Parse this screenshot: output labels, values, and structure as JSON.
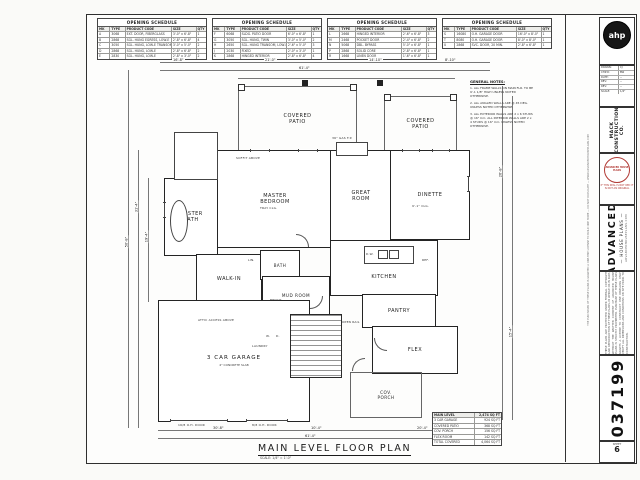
{
  "sheet": {
    "title": "MAIN LEVEL FLOOR PLAN",
    "scale": "SCALE: 1/4\" = 1'-0\""
  },
  "schedules": {
    "title": "OPENING SCHEDULE",
    "tables": [
      {
        "rows": [
          [
            "MK",
            "TYPE",
            "PRODUCT CODE",
            "SIZE",
            "QTY"
          ],
          [
            "A",
            "3068",
            "EXT. DOOR, FIBERGLASS",
            "3'-0\" x 6'-8\"",
            "1"
          ],
          [
            "B",
            "2868",
            "SGL. HUNG EGRESS, LOW-E",
            "2'-8\" x 6'-8\"",
            "4"
          ],
          [
            "C",
            "3050",
            "SGL. HUNG, LOW-E TRANSOM",
            "3'-0\" x 5'-0\"",
            "2"
          ],
          [
            "D",
            "2868",
            "SGL. HUNG, LOW-E",
            "2'-8\" x 6'-8\"",
            "2"
          ],
          [
            "E",
            "2830",
            "SGL. HUNG, LOW-E",
            "2'-8\" x 3'-0\"",
            "2"
          ]
        ]
      },
      {
        "rows": [
          [
            "MK",
            "TYPE",
            "PRODUCT CODE",
            "SIZE",
            "QTY"
          ],
          [
            "F",
            "6068",
            "SLDG. PATIO DOOR",
            "6'-0\" x 6'-8\"",
            "1"
          ],
          [
            "G",
            "3050",
            "SGL. HUNG, TWIN",
            "3'-0\" x 5'-0\"",
            "2"
          ],
          [
            "H",
            "2650",
            "SGL. HUNG TRANSOM, LOW-E",
            "2'-6\" x 5'-0\"",
            "3"
          ],
          [
            "J",
            "2030",
            "FIXED",
            "2'-0\" x 3'-0\"",
            "1"
          ],
          [
            "K",
            "2868",
            "HINGED INTERIOR",
            "2'-8\" x 6'-8\"",
            "4"
          ]
        ]
      },
      {
        "rows": [
          [
            "MK",
            "TYPE",
            "PRODUCT CODE",
            "SIZE",
            "QTY"
          ],
          [
            "L",
            "2668",
            "HINGED INTERIOR",
            "2'-6\" x 6'-8\"",
            "3"
          ],
          [
            "M",
            "2468",
            "POCKET DOOR",
            "2'-4\" x 6'-8\"",
            "2"
          ],
          [
            "N",
            "5068",
            "DBL. BYPASS",
            "5'-0\" x 6'-8\"",
            "1"
          ],
          [
            "P",
            "2868",
            "SOLID CORE",
            "2'-8\" x 6'-8\"",
            "1"
          ],
          [
            "R",
            "1668",
            "LINEN DOOR",
            "1'-6\" x 6'-8\"",
            "1"
          ]
        ]
      },
      {
        "rows": [
          [
            "MK",
            "TYPE",
            "PRODUCT CODE",
            "SIZE",
            "QTY"
          ],
          [
            "S",
            "16080",
            "O.H. GARAGE DOOR",
            "16'-0\" x 8'-0\"",
            "1"
          ],
          [
            "T",
            "8080",
            "O.H. GARAGE DOOR",
            "8'-0\" x 8'-0\"",
            "1"
          ],
          [
            "U",
            "2868",
            "SVC. DOOR, 20 MIN.",
            "2'-8\" x 6'-8\"",
            "1"
          ]
        ]
      }
    ]
  },
  "rooms": [
    {
      "label": "COVERED\nPATIO"
    },
    {
      "label": "COVERED\nPATIO"
    },
    {
      "label": "MASTER\nBEDROOM"
    },
    {
      "label": "MASTER\nBATH"
    },
    {
      "label": "WALK-IN"
    },
    {
      "label": "BATH"
    },
    {
      "label": "GREAT\nROOM"
    },
    {
      "label": "DINETTE"
    },
    {
      "label": "KITCHEN"
    },
    {
      "label": "PANTRY"
    },
    {
      "label": "MUD ROOM"
    },
    {
      "label": "3 CAR GARAGE",
      "sub": "4\" CONCRETE SLAB"
    },
    {
      "label": "FLEX"
    },
    {
      "label": "COV.\nPORCH"
    }
  ],
  "general_notes": {
    "title": "GENERAL NOTES:",
    "items": [
      "1. ALL FRAME WALLS ON MAIN FLR. TO BE 9'-1 1/8\" HIGH UNLESS NOTED OTHERWISE.",
      "2. ALL ANGLED WALLS ARE @ 45 DEG. UNLESS NOTED OTHERWISE.",
      "3. ALL EXTERIOR WALLS ARE 2 x 6 STUDS @ 16\" O.C. ALL INTERIOR WALLS ARE 2 x 4 STUDS @ 16\" O.C. UNLESS NOTED OTHERWISE."
    ]
  },
  "sqft": {
    "rows": [
      [
        "MAIN LEVEL",
        "2,474 SQ FT"
      ],
      [
        "3 CAR GARAGE",
        "924 SQ FT"
      ],
      [
        "COVERED PATIO",
        "368 SQ FT"
      ],
      [
        "COV. PORCH",
        "156 SQ FT"
      ],
      [
        "FLEX ROOM",
        "142 SQ FT"
      ],
      [
        "TOTAL COVERED",
        "4,064 SQ FT"
      ]
    ]
  },
  "dims": [
    "16'-8\"",
    "21'-0\"",
    "14'-10\"",
    "8'-10\"",
    "61'-4\"",
    "50'-8\"",
    "31'-4\"",
    "19'-4\"",
    "26'-8\"",
    "15'-4\"",
    "30'-8\"",
    "10'-4\"",
    "20'-4\"",
    "61'-4\""
  ],
  "annotations": [
    "ATTIC ACCESS ABOVE",
    "BENCH",
    "36\" GAS F.P.",
    "D.W.",
    "REF.",
    "LIN.",
    "SOFFIT ABOVE",
    "W.",
    "D.",
    "LAUNDRY",
    "OPEN RAIL",
    "9'-1\" CLG.",
    "TRAY CLG.",
    "16/8 O.H. DOOR",
    "8/8 O.H. DOOR"
  ],
  "titleblock": {
    "logo": "ahp",
    "client": "MACK CONSTRUCTION CO.",
    "rev_rows": [
      [
        "DRAWN:",
        "CJ"
      ],
      [
        "CHK'D:",
        "BW"
      ],
      [
        "DATE:",
        "--"
      ],
      [
        "REV:",
        "--"
      ],
      [
        "REV:",
        "--"
      ],
      [
        "SCALE:",
        "1/4\""
      ]
    ],
    "stamp_text": "ADVANCED HOUSE PLANS",
    "stamp_sub": "IF THIS SEAL IS NOT RED IT IS NOT AN ORIGINAL",
    "brand_name": "ADVANCED",
    "brand_sub": "— HOUSE PLANS —",
    "brand_url": "ADVANCEDHOUSEPLANS.COM",
    "disclaimer": "THESE PLANS ARE PROTECTED UNDER FEDERAL COPYRIGHT LAW. REPRODUCTION OF THESE PLANS, IN WHOLE OR IN PART, WITHOUT THE WRITTEN CONSENT OF ADVANCED HOUSE PLANS IS STRICTLY PROHIBITED. PURCHASE OF THESE PLANS GRANTS A LICENSE TO CONSTRUCT ONE DWELLING ONLY. VERIFY ALL DIMENSIONS AND CONDITIONS ON SITE PRIOR TO CONSTRUCTION.",
    "edge_note": "THE PURCHASER OF THESE PLANS IS GRANTED A ONE-TIME LICENSE TO BUILD ONE HOME — DO NOT DUPLICATE — WWW.ADVANCEDHOUSEPLANS.COM",
    "plan_number": "037199",
    "sheet_label": "SHEET",
    "sheet_number": "6"
  },
  "colors": {
    "wall_line": "#242424",
    "stamp_red": "#b23a35",
    "logo_black": "#161616"
  }
}
